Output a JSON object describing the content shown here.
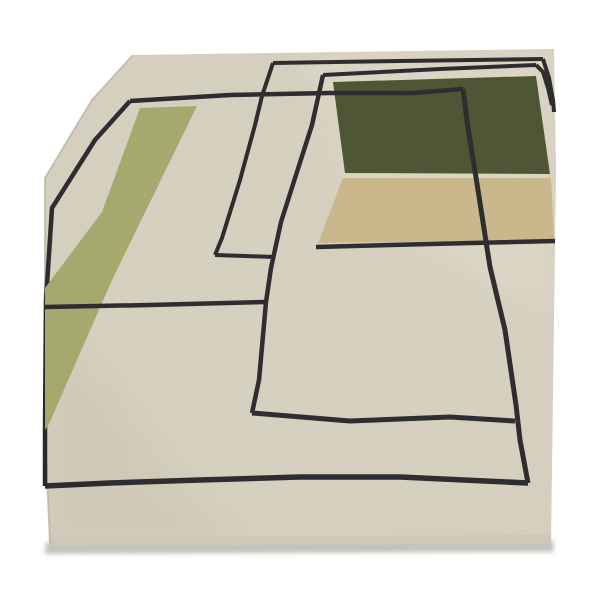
{
  "description": "Product photograph of a cream hand-tufted wool rug with black geometric line pattern, an olive-green side band, a dark forest-green block and a tan block, shown in perspective on a white background.",
  "palette": {
    "background": "#ffffff",
    "rug_cream": "#d7d1c0",
    "band_olive": "#a5a96c",
    "block_dark_green": "#4a5230",
    "block_tan": "#cbb88b",
    "line_black": "#28282c",
    "pile_edge": "#cfc8b7",
    "shadow": "#b0afa9",
    "edge_shade": "#bcb5a4",
    "highlight": "#e8e2d1",
    "low_shade": "#c9c2b0"
  },
  "scene": {
    "width": 600,
    "height": 600,
    "rug_outline": [
      [
        133,
        55
      ],
      [
        554,
        49
      ],
      [
        556,
        170
      ],
      [
        551,
        543
      ],
      [
        50,
        545
      ],
      [
        45,
        428
      ],
      [
        45,
        178
      ],
      [
        92,
        100
      ]
    ],
    "layers": [
      {
        "name": "floor-shadow",
        "type": "polygon",
        "points": [
          [
            46,
            542
          ],
          [
            553,
            540
          ],
          [
            554,
            552
          ],
          [
            45,
            554
          ]
        ],
        "fill": "#b0afa9",
        "opacity": 0.75,
        "filter": "soft"
      },
      {
        "name": "rug-body",
        "type": "polygon",
        "points": [
          [
            133,
            55
          ],
          [
            554,
            49
          ],
          [
            556,
            170
          ],
          [
            551,
            543
          ],
          [
            50,
            545
          ],
          [
            45,
            428
          ],
          [
            45,
            178
          ],
          [
            92,
            100
          ]
        ],
        "fill": "#d7d1c0"
      },
      {
        "name": "rug-highlight",
        "type": "polygon",
        "points": [
          [
            300,
            49
          ],
          [
            554,
            49
          ],
          [
            556,
            320
          ],
          [
            360,
            210
          ]
        ],
        "fill": "#e8e2d1",
        "opacity": 0.38,
        "filter": "soft18",
        "clip": true
      },
      {
        "name": "rug-low-shade",
        "type": "polygon",
        "points": [
          [
            45,
            310
          ],
          [
            230,
            545
          ],
          [
            45,
            545
          ]
        ],
        "fill": "#c9c2b0",
        "opacity": 0.4,
        "filter": "soft18",
        "clip": true
      },
      {
        "name": "pile-bottom-edge",
        "type": "polygon",
        "points": [
          [
            50,
            537
          ],
          [
            551,
            535
          ],
          [
            551,
            545
          ],
          [
            50,
            547
          ]
        ],
        "fill": "#cfc8b7",
        "opacity": 0.9,
        "clip": true
      },
      {
        "name": "left-edge-shade",
        "type": "polyline",
        "points": [
          [
            133,
            55
          ],
          [
            92,
            100
          ],
          [
            45,
            178
          ],
          [
            45,
            428
          ],
          [
            50,
            543
          ]
        ],
        "stroke": "#bcb5a4",
        "width": 2,
        "opacity": 0.8
      },
      {
        "name": "line-rect1-top",
        "type": "polyline",
        "points": [
          [
            273,
            63
          ],
          [
            400,
            61
          ],
          [
            543,
            59
          ]
        ],
        "stroke": "#28282c",
        "width": 4
      },
      {
        "name": "line-rect1-right",
        "type": "polyline",
        "points": [
          [
            543,
            59
          ],
          [
            549,
            78
          ],
          [
            553,
            100
          ],
          [
            554,
            112
          ]
        ],
        "stroke": "#28282c",
        "width": 4
      },
      {
        "name": "line-rect1-left",
        "type": "polyline",
        "points": [
          [
            273,
            63
          ],
          [
            262,
            96
          ],
          [
            255,
            125
          ],
          [
            240,
            180
          ],
          [
            222,
            238
          ],
          [
            215,
            255
          ]
        ],
        "stroke": "#28282c",
        "width": 4
      },
      {
        "name": "line-rect1-bottom",
        "type": "polyline",
        "points": [
          [
            215,
            255
          ],
          [
            245,
            256
          ],
          [
            274,
            257
          ]
        ],
        "stroke": "#28282c",
        "width": 4
      },
      {
        "name": "line-rect2-top",
        "type": "polyline",
        "points": [
          [
            323,
            75
          ],
          [
            440,
            69
          ],
          [
            536,
            65
          ]
        ],
        "stroke": "#28282c",
        "width": 4
      },
      {
        "name": "line-rect2-right",
        "type": "polyline",
        "points": [
          [
            536,
            65
          ],
          [
            543,
            72
          ],
          [
            548,
            88
          ],
          [
            552,
            105
          ]
        ],
        "stroke": "#28282c",
        "width": 4
      },
      {
        "name": "line-rect2-left",
        "type": "polyline",
        "points": [
          [
            323,
            75
          ],
          [
            312,
            125
          ],
          [
            296,
            175
          ],
          [
            281,
            222
          ],
          [
            271,
            268
          ],
          [
            266,
            302
          ],
          [
            259,
            380
          ],
          [
            252,
            413
          ]
        ],
        "stroke": "#28282c",
        "width": 4.5
      },
      {
        "name": "line-rect2-bottom",
        "type": "polyline",
        "points": [
          [
            252,
            413
          ],
          [
            350,
            421
          ],
          [
            450,
            417
          ],
          [
            515,
            421
          ]
        ],
        "stroke": "#28282c",
        "width": 5
      },
      {
        "name": "line-outer-left",
        "type": "polyline",
        "points": [
          [
            130,
            101
          ],
          [
            95,
            140
          ],
          [
            52,
            208
          ],
          [
            46,
            300
          ],
          [
            45,
            430
          ],
          [
            45,
            486
          ]
        ],
        "stroke": "#28282c",
        "width": 4.5
      },
      {
        "name": "band-olive-green",
        "type": "polygon",
        "points": [
          [
            140,
            108
          ],
          [
            197,
            106
          ],
          [
            112,
            280
          ],
          [
            49,
            424
          ],
          [
            45,
            430
          ],
          [
            45,
            288
          ],
          [
            102,
            212
          ]
        ],
        "fill": "#a5a96c"
      },
      {
        "name": "block-dark-green",
        "type": "polygon",
        "points": [
          [
            333,
            82
          ],
          [
            536,
            76
          ],
          [
            550,
            174
          ],
          [
            345,
            173
          ]
        ],
        "fill": "#4a5230"
      },
      {
        "name": "block-tan",
        "type": "polygon",
        "points": [
          [
            343,
            178
          ],
          [
            551,
            178
          ],
          [
            554,
            240
          ],
          [
            318,
            243
          ]
        ],
        "fill": "#cbb88b"
      },
      {
        "name": "line-outer-top",
        "type": "polyline",
        "points": [
          [
            130,
            101
          ],
          [
            230,
            95
          ],
          [
            330,
            93
          ],
          [
            413,
            93
          ],
          [
            463,
            89
          ]
        ],
        "stroke": "#28282c",
        "width": 4.5
      },
      {
        "name": "line-outer-right-vertical",
        "type": "polyline",
        "points": [
          [
            463,
            89
          ],
          [
            468,
            128
          ],
          [
            478,
            190
          ],
          [
            490,
            267
          ],
          [
            505,
            330
          ],
          [
            516,
            405
          ],
          [
            520,
            440
          ],
          [
            528,
            483
          ]
        ],
        "stroke": "#28282c",
        "width": 5
      },
      {
        "name": "line-outer-bottom",
        "type": "polyline",
        "points": [
          [
            528,
            483
          ],
          [
            400,
            477
          ],
          [
            300,
            477
          ],
          [
            200,
            480
          ],
          [
            110,
            483
          ],
          [
            45,
            486
          ]
        ],
        "stroke": "#28282c",
        "width": 5.5
      },
      {
        "name": "line-mid-left-horizontal",
        "type": "polyline",
        "points": [
          [
            45,
            307
          ],
          [
            150,
            305
          ],
          [
            266,
            302
          ]
        ],
        "stroke": "#28282c",
        "width": 4.5
      },
      {
        "name": "line-under-tan",
        "type": "polyline",
        "points": [
          [
            316,
            247
          ],
          [
            430,
            244
          ],
          [
            555,
            241
          ]
        ],
        "stroke": "#28282c",
        "width": 4.5
      }
    ]
  }
}
